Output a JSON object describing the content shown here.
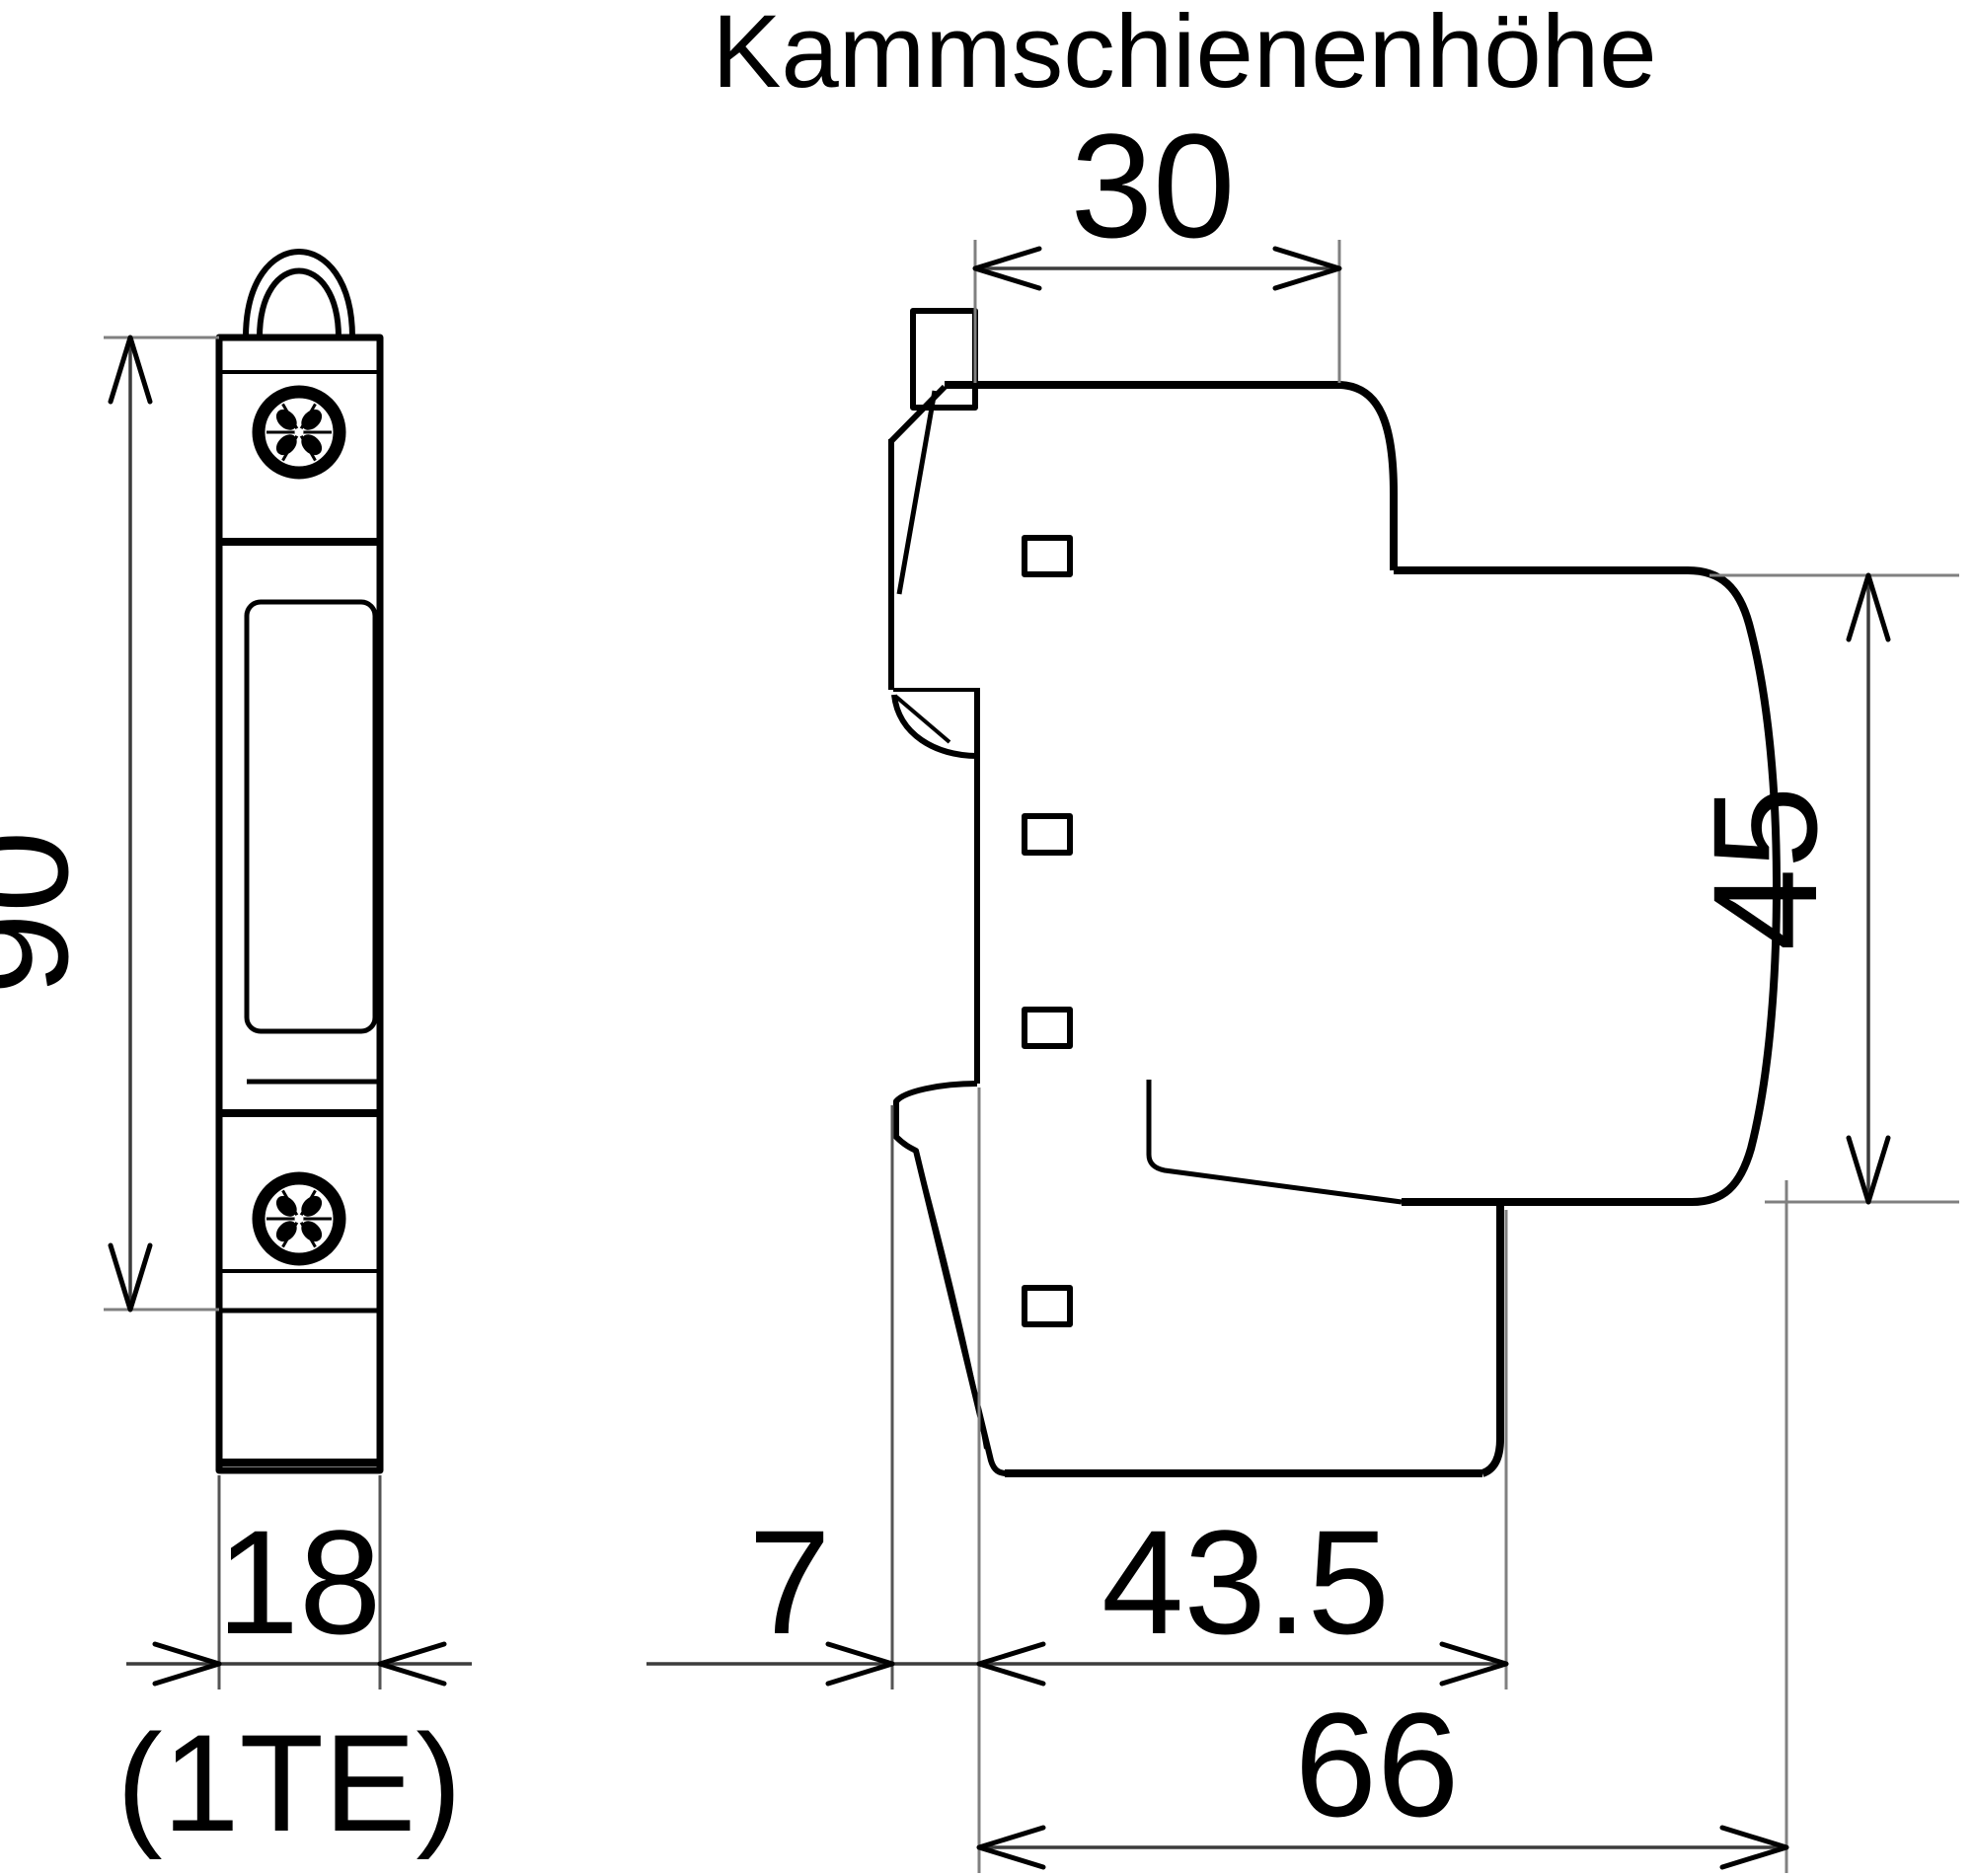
{
  "drawing": {
    "title": "Kammschienenhöhe",
    "views": {
      "front": {
        "name": "front view (1 module wide)"
      },
      "side": {
        "name": "side view (DIN rail profile)"
      }
    },
    "dimensions": {
      "height_90": "90",
      "width_18": "18",
      "width_unit": "(1TE)",
      "comb_rail_height_30": "30",
      "front_height_45": "45",
      "rail_clip_depth_7": "7",
      "base_depth_43_5": "43.5",
      "total_depth_66": "66"
    },
    "colors": {
      "ink": "#000000",
      "dimension_line": "#3c3c3c",
      "extension_line": "#808080",
      "background": "#ffffff"
    }
  }
}
